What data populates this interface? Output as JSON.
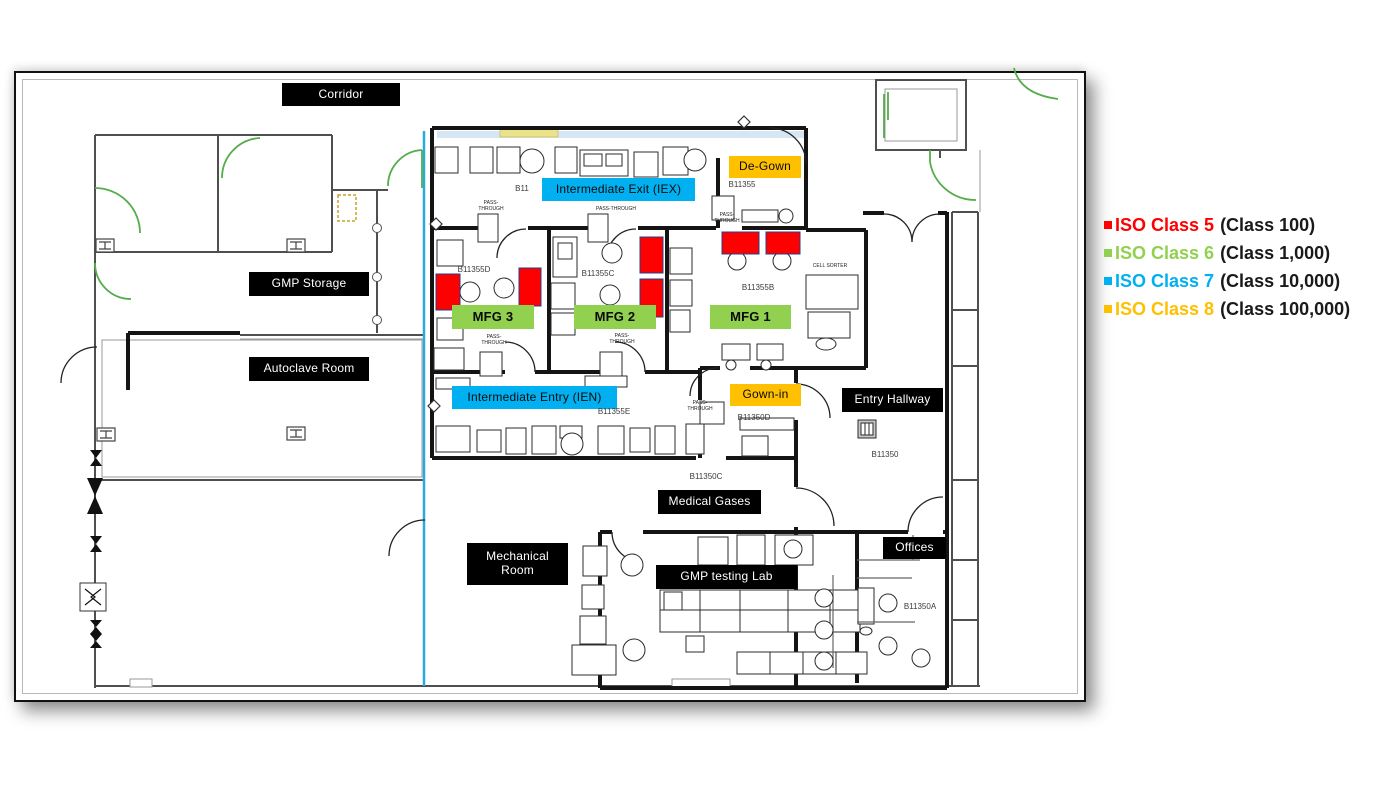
{
  "colors": {
    "iso5_red": "#FF0000",
    "iso6_green": "#92D050",
    "iso7_blue": "#00B0F0",
    "iso8_orange": "#FFC000",
    "label_black": "#000000"
  },
  "legend": {
    "items": [
      {
        "label": "ISO Class 5",
        "detail": "(Class 100)",
        "color": "#FF0000"
      },
      {
        "label": "ISO Class 6",
        "detail": "(Class 1,000)",
        "color": "#92D050"
      },
      {
        "label": "ISO Class 7",
        "detail": "(Class 10,000)",
        "color": "#00B0F0"
      },
      {
        "label": "ISO Class 8",
        "detail": "(Class 100,000)",
        "color": "#FFC000"
      }
    ]
  },
  "rooms": {
    "corridor": "Corridor",
    "gmp_storage": "GMP Storage",
    "autoclave_room": "Autoclave Room",
    "de_gown": "De-Gown",
    "gown_in": "Gown-in",
    "intermediate_exit": "Intermediate Exit (IEX)",
    "intermediate_entry": "Intermediate Entry (IEN)",
    "mfg_1": "MFG 1",
    "mfg_2": "MFG 2",
    "mfg_3": "MFG 3",
    "entry_hallway": "Entry Hallway",
    "medical_gases": "Medical Gases",
    "mechanical_room": "Mechanical Room",
    "gmp_testing_lab": "GMP testing Lab",
    "offices": "Offices"
  },
  "room_numbers": {
    "b11355": "B11355",
    "b11355a_partial": "B11",
    "b11355b": "B11355B",
    "b11355c": "B11355C",
    "b11355d": "B11355D",
    "b11355e": "B11355E",
    "b11350": "B11350",
    "b11350a": "B11350A",
    "b11350c": "B11350C",
    "b11350d": "B11350D"
  },
  "annotations": {
    "pass_through": "PASS-THROUGH",
    "cell_sorter": "CELL SORTER"
  }
}
